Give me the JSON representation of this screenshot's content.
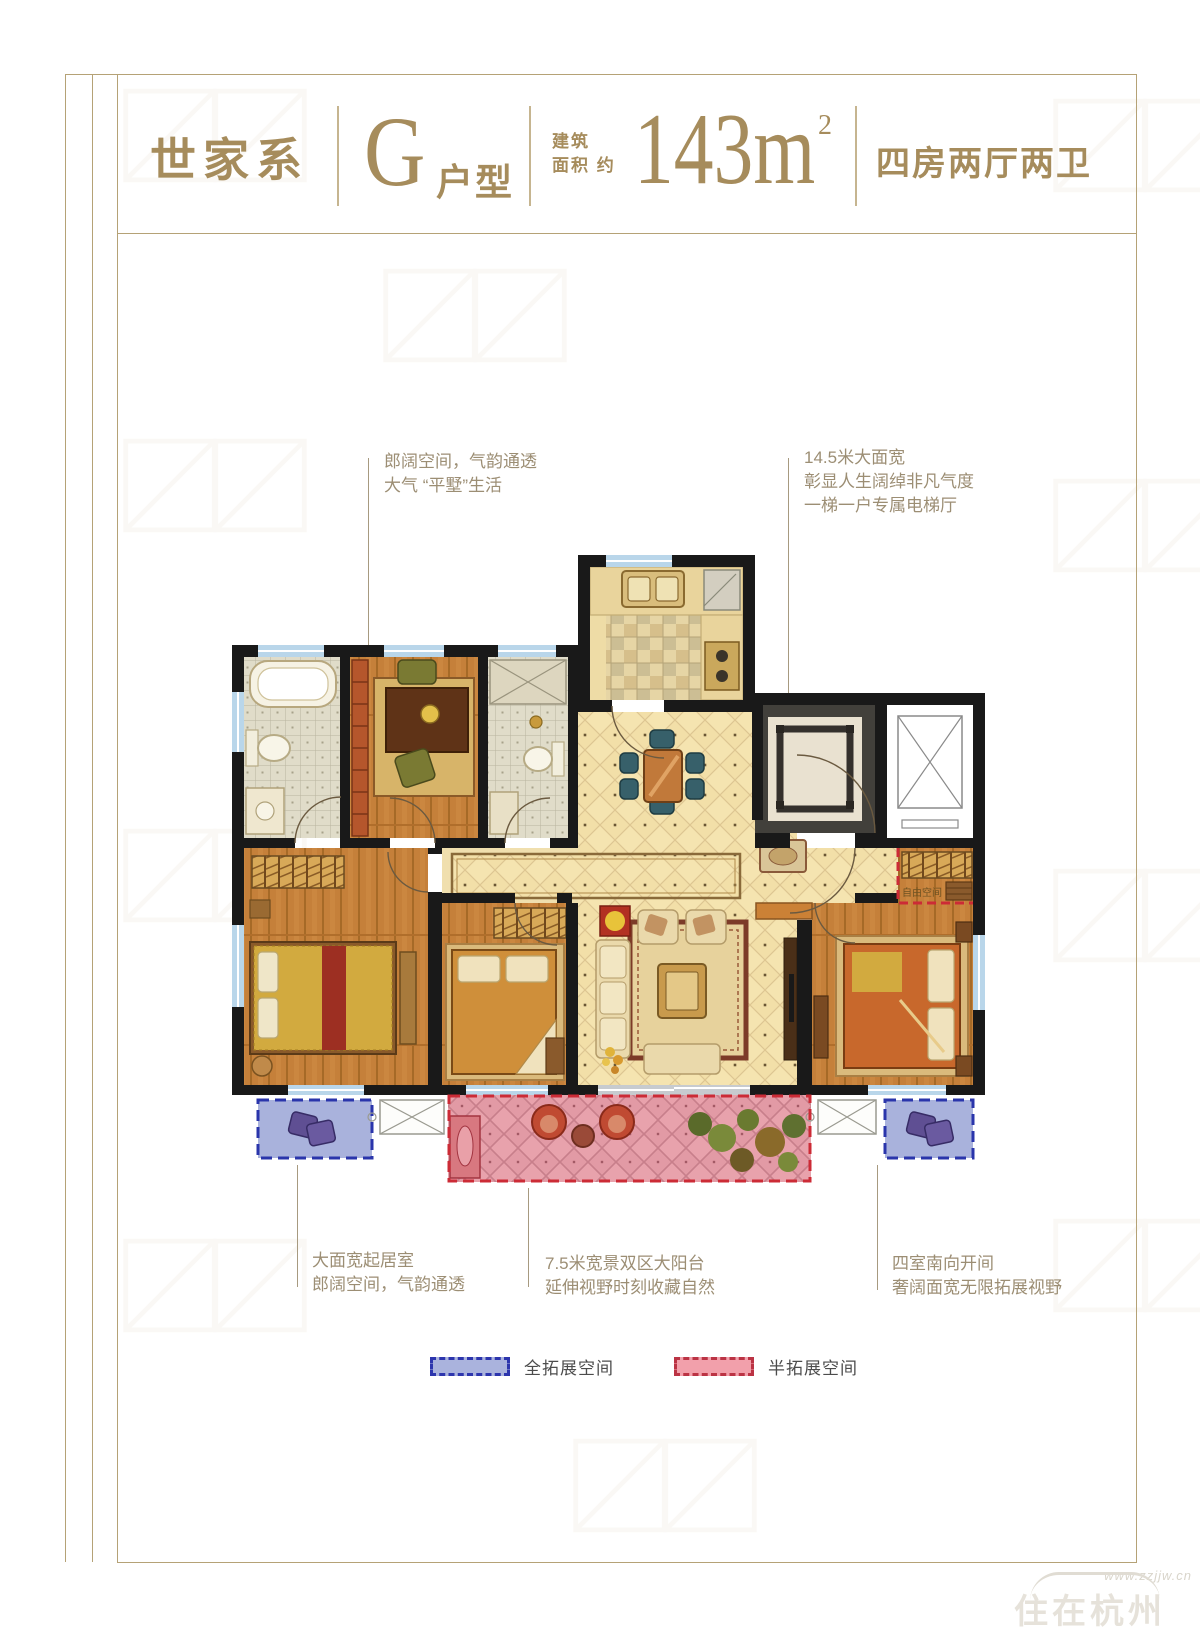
{
  "header": {
    "series": "世家系",
    "unit_letter": "G",
    "unit_suffix": "户型",
    "area_label_line1": "建筑",
    "area_label_line2": "面积 约",
    "area_value": "143m",
    "area_sup": "2",
    "layout": "四房两厅两卫"
  },
  "annotations": {
    "top_left": {
      "lines": [
        "郎阔空间，气韵通透",
        "大气 “平墅”生活"
      ]
    },
    "top_right": {
      "lines": [
        "14.5米大面宽",
        "彰显人生阔绰非凡气度",
        "一梯一户专属电梯厅"
      ]
    },
    "bottom_left": {
      "lines": [
        "大面宽起居室",
        "郎阔空间，气韵通透"
      ]
    },
    "bottom_center": {
      "lines": [
        "7.5米宽景双区大阳台",
        "延伸视野时刻收藏自然"
      ]
    },
    "bottom_right": {
      "lines": [
        "四室南向开间",
        "奢阔面宽无限拓展视野"
      ]
    }
  },
  "floorplan": {
    "free_space_label": "自由空间"
  },
  "legend": {
    "full": {
      "label": "全拓展空间",
      "fill": "#aab3dd",
      "border": "#2c35ad"
    },
    "half": {
      "label": "半拓展空间",
      "fill": "#f2a0ab",
      "border": "#bb3344"
    }
  },
  "watermark": {
    "url": "www.zzjjw.cn",
    "logo": "住在杭州"
  },
  "colors": {
    "gold_text": "#a68c5c",
    "frame": "#b5a276",
    "annotation_text": "#9c8e74",
    "wall": "#191919",
    "window": "#b9d6ea",
    "wood_floor": "#c5803a",
    "tile_floor": "#e0dcc9",
    "hall_tile": "#f5e4b0",
    "balcony_pink": "#e8a2ac",
    "full_extension_blue": "#2c35ad",
    "half_extension_red": "#cc2b36"
  }
}
